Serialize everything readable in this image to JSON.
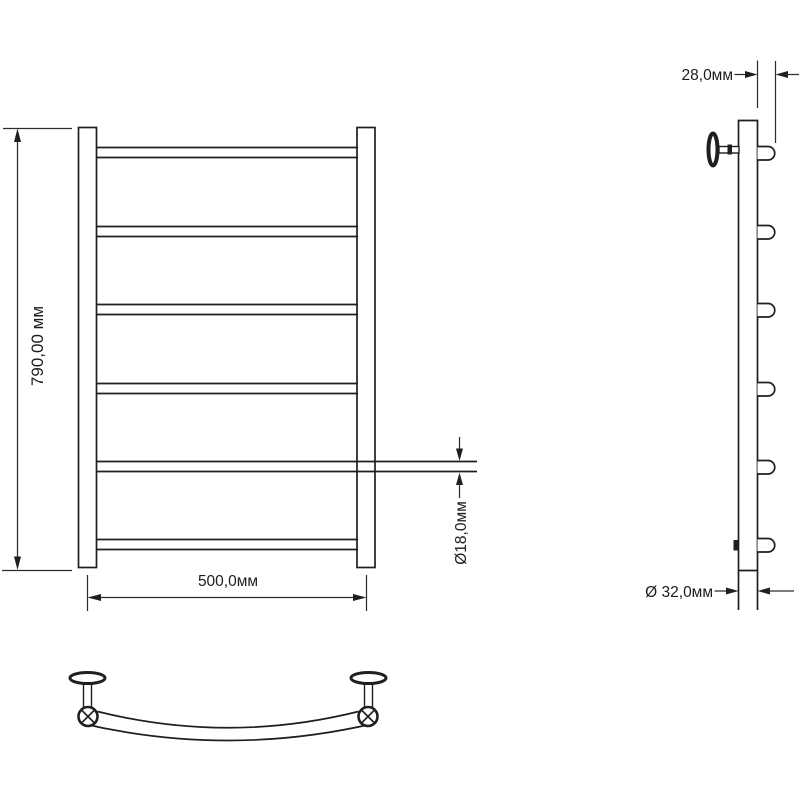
{
  "page": {
    "background": "#ffffff",
    "description": "Technical dimension drawing of a ladder-style heated towel rail shown in three orthographic views: front view, side profile view and top view"
  },
  "style": {
    "line_color": "#1f1f1f",
    "dim_line_color": "#2e2e2e",
    "text_color": "#1c1c1c"
  },
  "front_view": {
    "rung_count": 6,
    "post_count": 2,
    "dims": {
      "height": "790,00 мм",
      "width": "500,0мм",
      "rung_diameter": "Ø18,0мм"
    }
  },
  "side_view": {
    "rung_count": 6,
    "bracket_count": 2,
    "dims": {
      "wall_offset": "28,0мм",
      "post_diameter": "Ø 32,0мм"
    }
  },
  "top_view": {
    "bracket_count": 2,
    "post_section_count": 2,
    "curved_rung_count": 1
  }
}
